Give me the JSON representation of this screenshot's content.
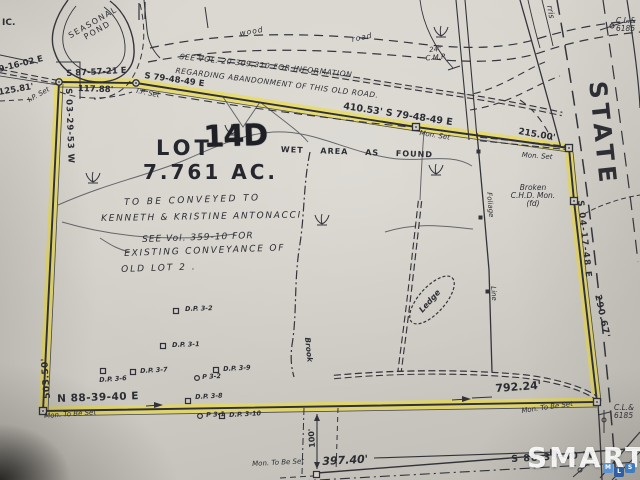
{
  "parcel": {
    "lot_prefix": "LOT",
    "lot_number": "14D",
    "area": "7.761 AC."
  },
  "notes": {
    "abandonment": [
      "SEE VOL. 20-309,310 FOR INFORMATION",
      "REGARDING ABANDONMENT OF THIS OLD ROAD."
    ],
    "conveyance": [
      "TO BE CONVEYED TO",
      "KENNETH & KRISTINE ANTONACCI"
    ],
    "reference": [
      "SEE Vol. 359-10 FOR",
      "EXISTING CONVEYANCE OF",
      "OLD LOT 2 ."
    ],
    "wet_area": "WET AREA AS FOUND"
  },
  "bearings": {
    "nw_partial": "9-16-02 E",
    "nw_dist": "125.81'",
    "n1": "S 87-57-21 E",
    "n1_dist": "117.88'",
    "n2": "S 79-48-49 E",
    "n3": "410.53' S 79-48-49 E",
    "n3_dist": "215.00'",
    "east": "S 04-17-48 E",
    "east_dist": "290.67'",
    "west": "S 03-29-53 W",
    "west_dist": "503.50'",
    "south": "N 88-39-40 E",
    "south_dist": "792.24'",
    "road": "S 88-39-40 W",
    "road_dist": "397.40'",
    "offset_dist": "100'"
  },
  "monuments": {
    "ip_set": "I.P. Set",
    "mon_set": "Mon. Set",
    "mon_to_be_set": "Mon. To Be Set",
    "broken": [
      "Broken",
      "C.H.D. Mon.",
      "(fd)"
    ]
  },
  "features": {
    "ic": "IC.",
    "pond": [
      "SEASONAL",
      "POND"
    ],
    "wood": "wood",
    "road_word": "road",
    "cmp": [
      "24\"",
      "C.M.P."
    ],
    "street_partial": "rris",
    "state": "STATE",
    "utility": [
      "C.L.&",
      "6185"
    ],
    "brook": "Brook",
    "ledge": "Ledge",
    "foliage": "Foliage",
    "foliage2": "Line"
  },
  "markers": {
    "dp32": "D.P. 3-2",
    "dp31": "D.P. 3-1",
    "dp36": "D.P. 3-6",
    "dp37": "D.P. 3-7",
    "p32": "P 3-2",
    "dp39": "D.P. 3-9",
    "dp38": "D.P. 3-8",
    "p31": "P 3-1",
    "dp310": "D.P. 3-10"
  },
  "watermark": {
    "brand": "SMART",
    "tiles": [
      "M",
      "L",
      "S"
    ]
  },
  "colors": {
    "highlight": "#eedc3c",
    "ink": "#32333a",
    "paper": "#d4d0c9",
    "watermark_blue": "#3f7cc0"
  }
}
